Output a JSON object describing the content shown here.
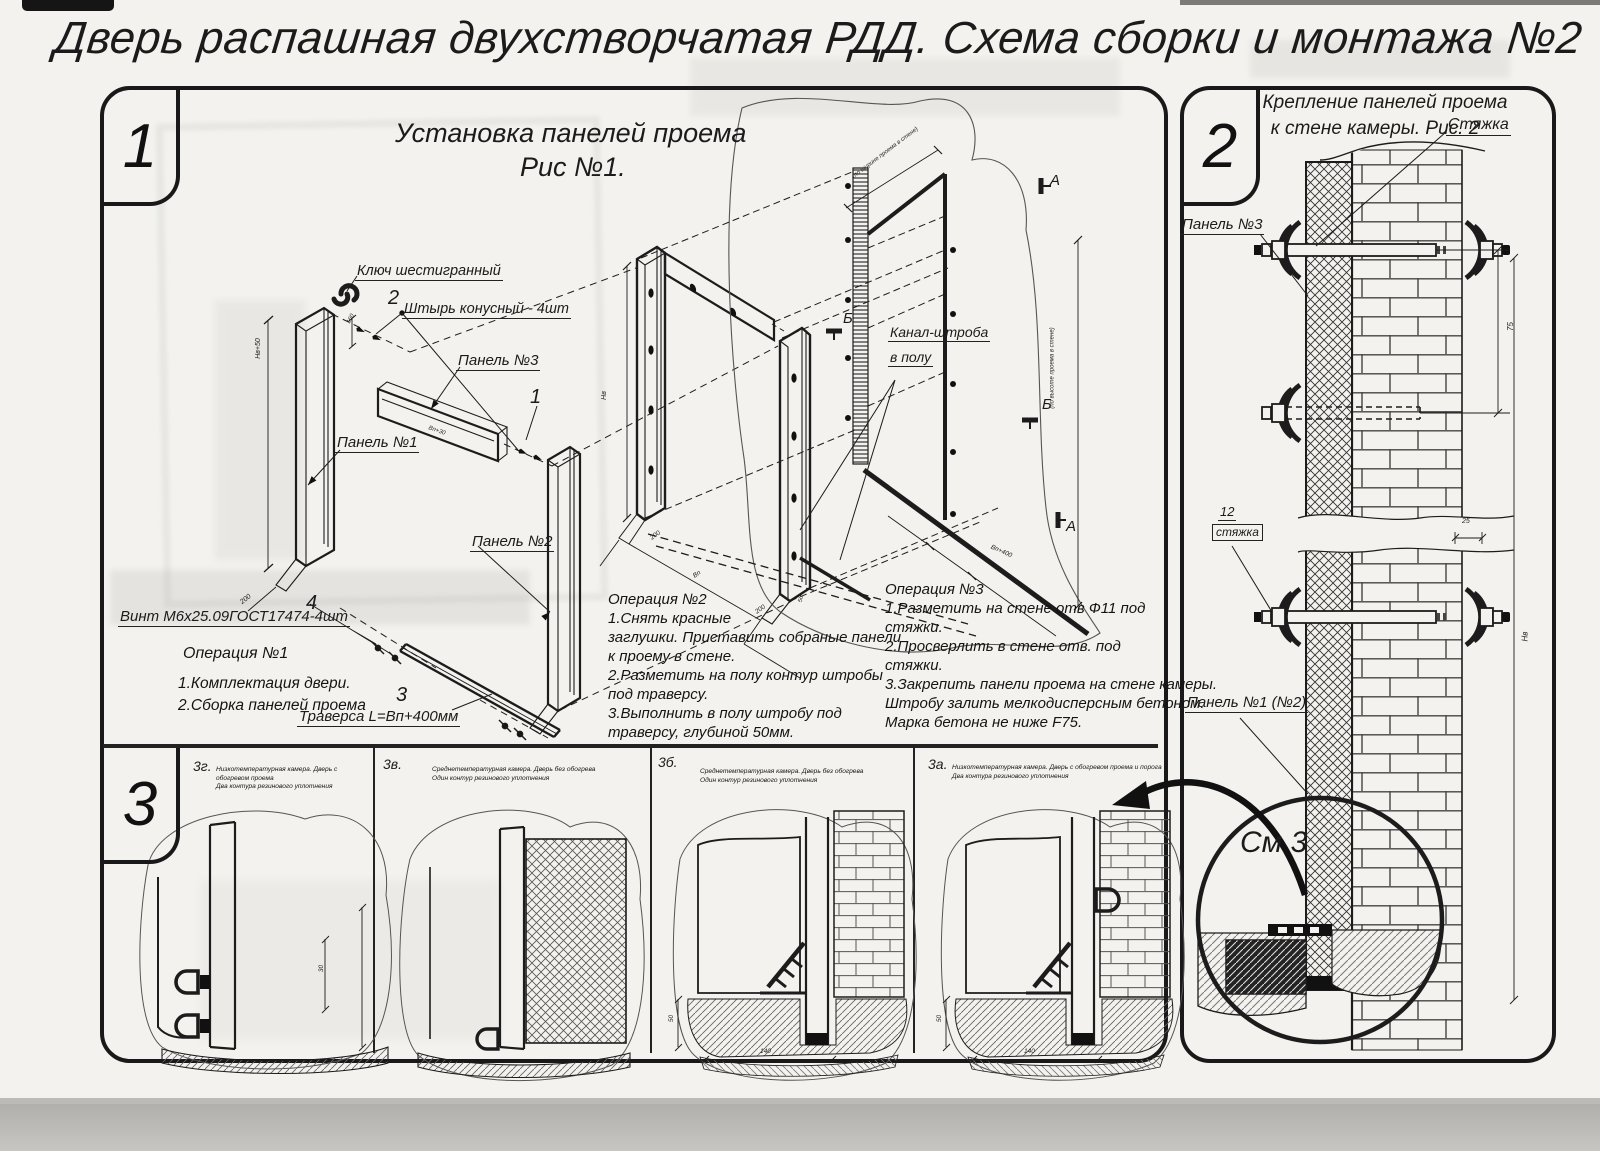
{
  "page": {
    "title": "Дверь распашная двухстворчатая РДД.  Схема сборки и монтажа №2"
  },
  "section1": {
    "badge": "1",
    "fig_title_line1": "Установка панелей проема",
    "fig_title_line2": "Рис №1.",
    "labels": {
      "hex_key": "Ключ шестигранный",
      "pos2": "2",
      "pin": "Штырь конусный - 4шт",
      "panel3": "Панель №3",
      "pos1": "1",
      "panel1": "Панель №1",
      "panel2": "Панель №2",
      "pos4": "4",
      "screw": "Винт М6х25.09ГОСТ17474-4шт",
      "pos3": "3",
      "traverse": "Траверса  L=Bп+400мм",
      "channel1": "Канал-штроба",
      "channel2": "в полу",
      "mark_a": "А",
      "mark_b": "Б"
    },
    "dims": {
      "panel1_height": "Hв+50",
      "panel1_width": "200",
      "pin_gap": "160",
      "panel3_len": "Bп+30",
      "frame_height": "Hв",
      "frame_width": "Bп",
      "d200a": "200",
      "d200b": "200",
      "d50": "50",
      "bp400": "Bп+400",
      "wall_w_note": "(по ширине проема в стене)",
      "wall_h_note": "(по высоте проема в стене)"
    },
    "op1": {
      "title": "Операция №1",
      "l1": "1.Комплектация двери.",
      "l2": "2.Сборка панелей проема"
    },
    "op2": {
      "title": "Операция №2",
      "lines": [
        "1.Снять красные",
        "заглушки. Приставить собраные панели",
        "к проему в стене.",
        "2.Разметить на полу контур штробы",
        "под траверсу.",
        "3.Выполнить в полу штробу под",
        "траверсу, глубиной 50мм."
      ]
    },
    "op3": {
      "title": "Операция №3",
      "lines": [
        "1.Разметить на стене отв Ф11 под",
        "стяжки.",
        "2.Просверлить в стене отв.  под",
        "стяжки.",
        "3.Закрепить панели проема на стене камеры.",
        "Штробу залить мелкодисперсным бетоном.",
        "Марка бетона не ниже   F75."
      ]
    }
  },
  "section2": {
    "badge": "2",
    "title_line1": "Крепление панелей проема",
    "title_line2": "к стене камеры. Рис. 2",
    "labels": {
      "tie_top": "Стяжка",
      "panel3": "Панель №3",
      "pos12": "12",
      "tie_mid": "стяжка",
      "panel12": "Панель №1 (№2)",
      "see3": "См 3"
    },
    "dims": {
      "d75": "75",
      "d25": "25",
      "hv": "Hв"
    }
  },
  "section3": {
    "badge": "3",
    "figures": [
      {
        "label": "3г.",
        "cap1": "Низкотемпературная камера. Дверь с обогревом проема",
        "cap2": "Два контура резинового уплотнения"
      },
      {
        "label": "3в.",
        "cap1": "Среднетемпературная камера. Дверь без обогрева",
        "cap2": "Один контур резинового уплотнения"
      },
      {
        "label": "3б.",
        "cap1": "Среднетемпературная камера. Дверь без обогрева",
        "cap2": "Один контур резинового уплотнения"
      },
      {
        "label": "3а.",
        "cap1": "Низкотемпературная камера. Дверь с обогревом проема и порога",
        "cap2": "Два контура резинового уплотнения"
      }
    ],
    "dims": {
      "d30": "30",
      "d50a": "50",
      "d140a": "140",
      "d50b": "50",
      "d140b": "140"
    }
  }
}
